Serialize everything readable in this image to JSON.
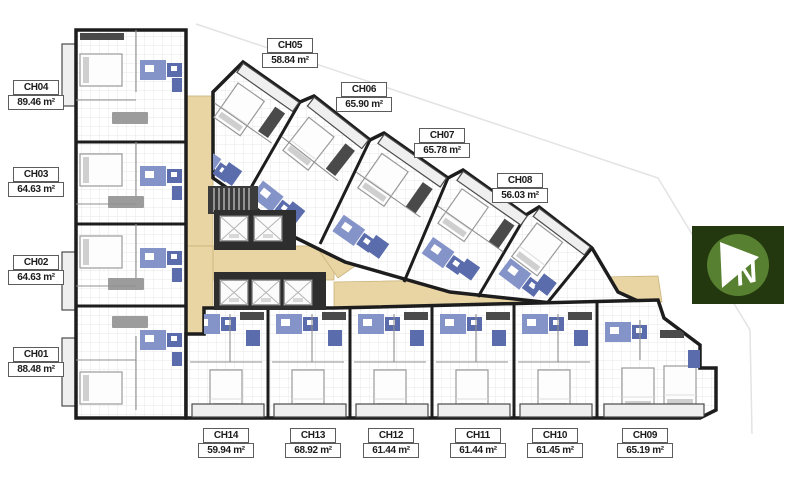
{
  "plan": {
    "units": [
      {
        "id": "CH01",
        "area": "88.48 m²"
      },
      {
        "id": "CH02",
        "area": "64.63 m²"
      },
      {
        "id": "CH03",
        "area": "64.63 m²"
      },
      {
        "id": "CH04",
        "area": "89.46 m²"
      },
      {
        "id": "CH05",
        "area": "58.84 m²"
      },
      {
        "id": "CH06",
        "area": "65.90 m²"
      },
      {
        "id": "CH07",
        "area": "65.78 m²"
      },
      {
        "id": "CH08",
        "area": "56.03 m²"
      },
      {
        "id": "CH09",
        "area": "65.19 m²"
      },
      {
        "id": "CH10",
        "area": "61.45 m²"
      },
      {
        "id": "CH11",
        "area": "61.44 m²"
      },
      {
        "id": "CH12",
        "area": "61.44 m²"
      },
      {
        "id": "CH13",
        "area": "68.92 m²"
      },
      {
        "id": "CH14",
        "area": "59.94 m²"
      }
    ],
    "compass": {
      "letter": "N"
    },
    "colors": {
      "wall": "#1d1d1d",
      "corridor": "#e8d5a3",
      "blue": "#8494c8",
      "blue_dark": "#5a6cab",
      "gray_dark": "#4a4a4a",
      "gray_mid": "#9c9c9c",
      "compass_bg": "#24380f",
      "compass_circle": "#578030"
    }
  }
}
